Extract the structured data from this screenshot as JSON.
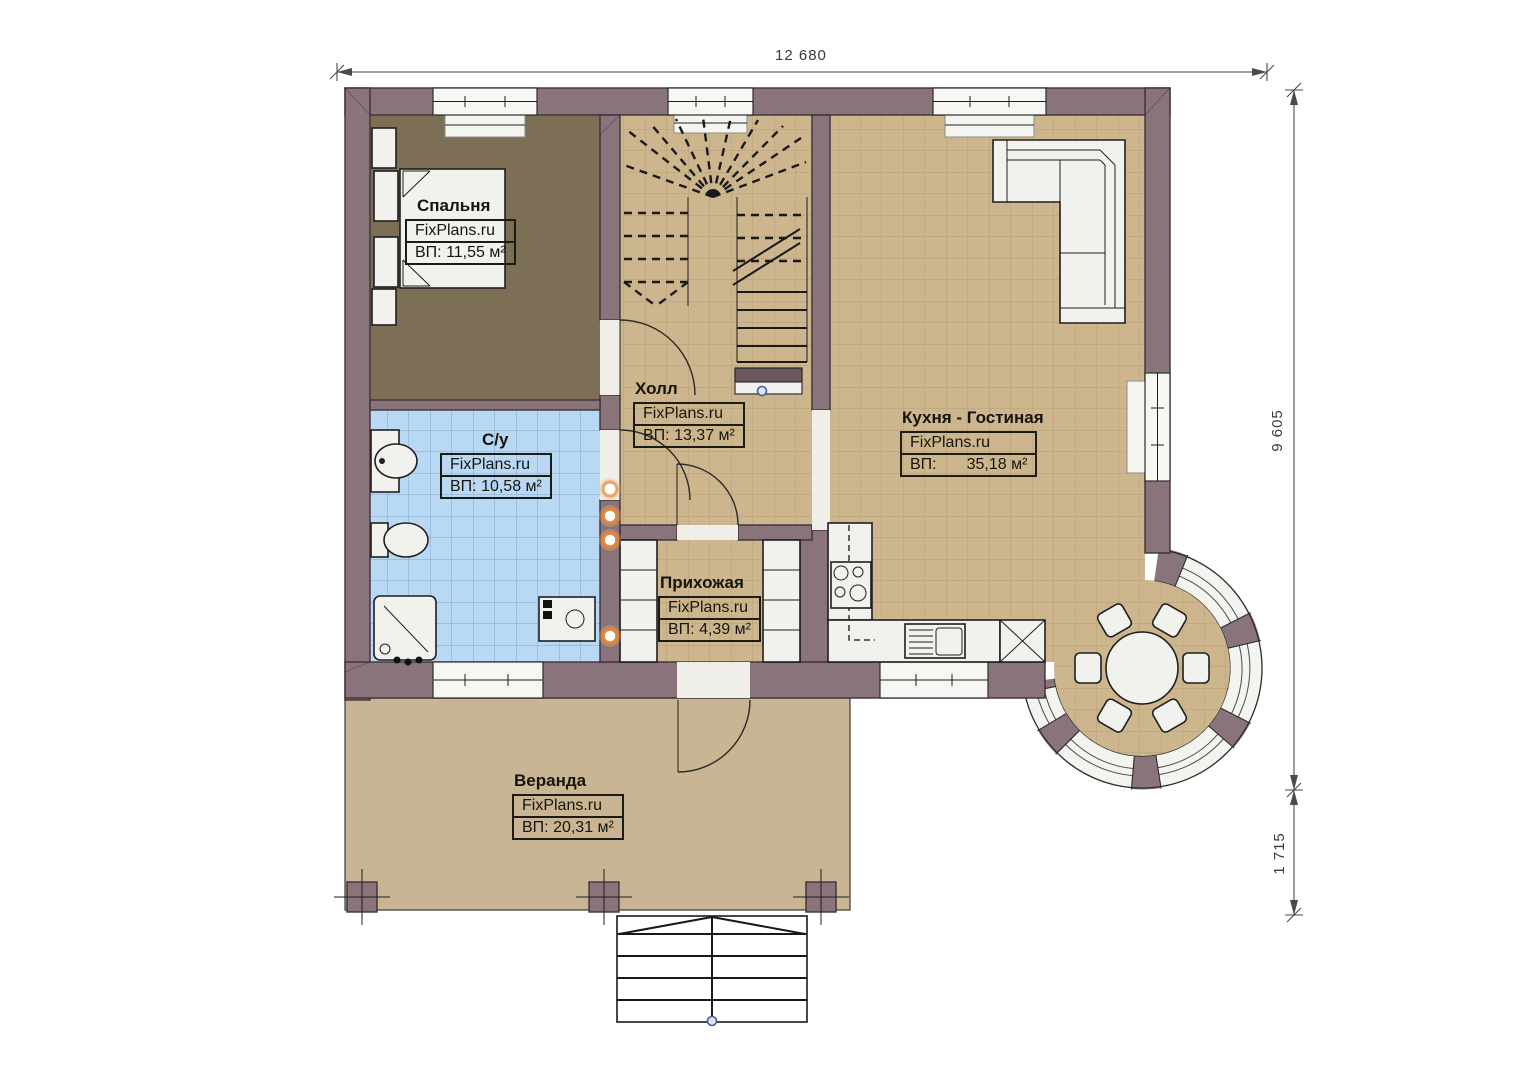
{
  "title": "План 1 этажа — FixPlans.ru",
  "brand": "FixPlans.ru",
  "dimensions": {
    "width_total": "12 680",
    "height_main": "9 605",
    "height_veranda": "1 715"
  },
  "rooms": [
    {
      "id": "bedroom",
      "name": "Спальня",
      "brand": "FixPlans.ru",
      "area": "ВП: 11,55 м²"
    },
    {
      "id": "hall",
      "name": "Холл",
      "brand": "FixPlans.ru",
      "area": "ВП: 13,37 м²"
    },
    {
      "id": "bathroom",
      "name": "С/у",
      "brand": "FixPlans.ru",
      "area": "ВП: 10,58 м²"
    },
    {
      "id": "entry-hall",
      "name": "Прихожая",
      "brand": "FixPlans.ru",
      "area": "ВП: 4,39 м²"
    },
    {
      "id": "kitchen-living",
      "name": "Кухня - Гостиная",
      "brand": "FixPlans.ru",
      "area_prefix": "ВП:",
      "area_value": "35,18 м²"
    },
    {
      "id": "veranda",
      "name": "Веранда",
      "brand": "FixPlans.ru",
      "area": "ВП: 20,31 м²"
    }
  ],
  "colors": {
    "wall": "#8a747c",
    "floor_tile_tan": "#cdb68e",
    "floor_tile_blue": "#b9d8f3",
    "floor_bedroom": "#7d6f55",
    "floor_veranda": "#c9b494",
    "marker_orange": "#e0873f",
    "marker_blue": "#3f5f9e"
  }
}
